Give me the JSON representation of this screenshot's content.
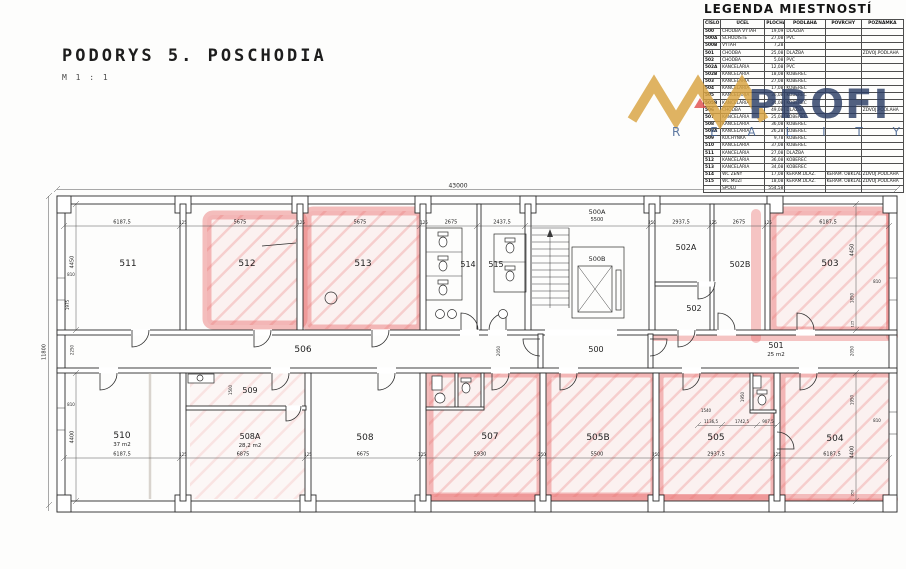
{
  "title": {
    "main": "PODORYS 5. POSCHODIA",
    "scale": "M 1 : 1"
  },
  "logo": {
    "max": "MAX",
    "profi": "PROFI",
    "reality": "R E A L I T Y",
    "gold": "#d9a441",
    "navy": "#2c3e66",
    "red": "#e25050"
  },
  "legend": {
    "title": "LEGENDA MIESTNOSTÍ",
    "columns": [
      "ČÍSLO",
      "ÚČEL",
      "PLOCHA",
      "PODLAHA",
      "POVRCHY",
      "POZNÁMKA"
    ],
    "rows": [
      [
        "500",
        "CHODBA VÝŤAH",
        "19,09",
        "DLAŽBA",
        "",
        ""
      ],
      [
        "500A",
        "SCHODIŠTE",
        "27,08",
        "PVC",
        "",
        ""
      ],
      [
        "500B",
        "VÝŤAH",
        "7,28",
        "",
        "",
        ""
      ],
      [
        "501",
        "CHODBA",
        "25,08",
        "DLAŽBA",
        "",
        "ZDVOJ.PODLAHA"
      ],
      [
        "502",
        "CHODBA",
        "5,08",
        "PVC",
        "",
        ""
      ],
      [
        "502A",
        "KANCELÁRIA",
        "12,08",
        "PVC",
        "",
        ""
      ],
      [
        "502B",
        "KANCELÁRIA",
        "18,08",
        "KOBEREC",
        "",
        ""
      ],
      [
        "503",
        "KANCELÁRIA",
        "27,08",
        "KOBEREC",
        "",
        ""
      ],
      [
        "504",
        "KANCELÁRIA",
        "17,08",
        "KOBEREC",
        "",
        ""
      ],
      [
        "505",
        "KANCELÁRIA",
        "36,08",
        "KOBEREC",
        "",
        ""
      ],
      [
        "505B",
        "KANCELÁRIA",
        "34,08",
        "KOBEREC",
        "",
        ""
      ],
      [
        "506",
        "CHODBA",
        "49,08",
        "DLAŽBA",
        "",
        "ZDVOJ.PODLAHA"
      ],
      [
        "507",
        "KANCELÁRIA",
        "25,08",
        "KOBEREC",
        "",
        ""
      ],
      [
        "508",
        "KANCELÁRIA",
        "36,08",
        "KOBEREC",
        "",
        ""
      ],
      [
        "508A",
        "KANCELÁRIA",
        "26,28",
        "KOBEREC",
        "",
        ""
      ],
      [
        "509",
        "KUCHYNKA",
        "9,78",
        "KOBEREC",
        "",
        ""
      ],
      [
        "510",
        "KANCELÁRIA",
        "37,08",
        "KOBEREC",
        "",
        ""
      ],
      [
        "511",
        "KANCELÁRIA",
        "27,08",
        "DLAŽBA",
        "",
        ""
      ],
      [
        "512",
        "KANCELÁRIA",
        "36,08",
        "KOBEREC",
        "",
        ""
      ],
      [
        "513",
        "KANCELÁRIA",
        "34,08",
        "KOBEREC",
        "",
        ""
      ],
      [
        "514",
        "WC ŽENY",
        "17,08",
        "KERAM.DLAŽ.",
        "KERAM. OBKLAD",
        "ZDVOJ.PODLAHA"
      ],
      [
        "515",
        "WC MUŽI",
        "18,08",
        "KERAM.DLAŽ.",
        "KERAM. OBKLAD",
        "ZDVOJ.PODLAHA"
      ],
      [
        "",
        "SPOLU",
        "554,58",
        "",
        "",
        ""
      ]
    ]
  },
  "plan": {
    "room_labels": [
      "511",
      "512",
      "513",
      "514",
      "515",
      "500A",
      "500B",
      "502A",
      "502B",
      "502",
      "503",
      "506",
      "500",
      "501",
      "25 m2",
      "509",
      "510",
      "37 m2",
      "508A",
      "28,2 m2",
      "508",
      "507",
      "505B",
      "505",
      "504"
    ],
    "dims": [
      "43000",
      "11800",
      "6187,5",
      "5675",
      "2675",
      "2437,5",
      "5500",
      "2937,5",
      "6875",
      "6675",
      "5930",
      "1136,5",
      "1742,5",
      "907,5",
      "4450",
      "2250",
      "4400",
      "810",
      "1975",
      "1850",
      "2050",
      "1950",
      "350",
      "125",
      "250",
      "1500",
      "1540"
    ],
    "highlighted_rooms": [
      "512",
      "513",
      "503",
      "501",
      "507",
      "505B",
      "505",
      "504"
    ],
    "highlight_color": "#e96e6e",
    "line_color": "#2c2c2c"
  }
}
